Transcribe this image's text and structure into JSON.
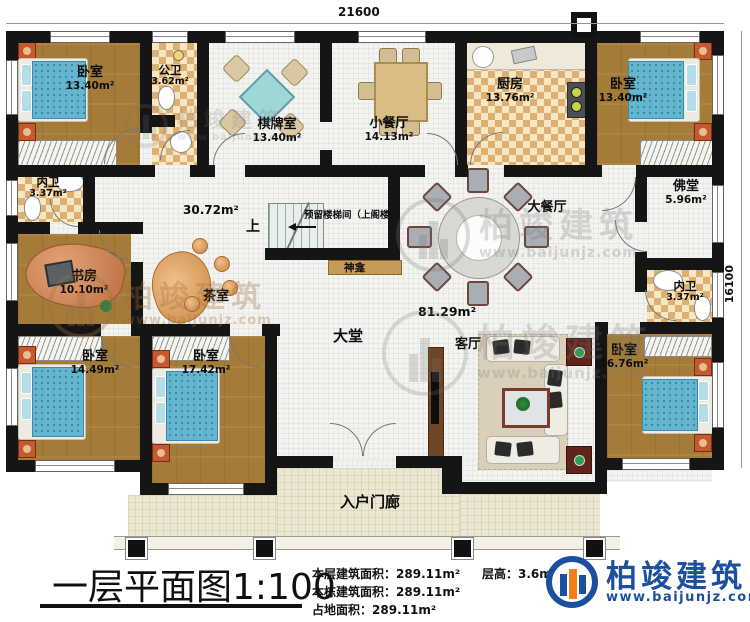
{
  "dimensions": {
    "top": "21600",
    "right": "16100"
  },
  "rooms": {
    "bedroom_tl": {
      "label": "卧室",
      "area": "13.40m²"
    },
    "public_bath": {
      "label": "公卫",
      "area": "3.62m²"
    },
    "chess_room": {
      "label": "棋牌室",
      "area": "13.40m²"
    },
    "small_dining": {
      "label": "小餐厅",
      "area": "14.13m²"
    },
    "kitchen": {
      "label": "厨房",
      "area": "13.76m²"
    },
    "bedroom_tr": {
      "label": "卧室",
      "area": "13.40m²"
    },
    "inner_bath_left": {
      "label": "内卫",
      "area": "3.37m²"
    },
    "study": {
      "label": "书房",
      "area": "10.10m²"
    },
    "tea_room": {
      "label": "茶室"
    },
    "main_dining": {
      "label": "大餐厅"
    },
    "buddha_hall": {
      "label": "佛堂",
      "area": "5.96m²"
    },
    "inner_bath_right": {
      "label": "内卫",
      "area": "3.37m²"
    },
    "bedroom_bl": {
      "label": "卧室",
      "area": "14.49m²"
    },
    "bedroom_bm": {
      "label": "卧室",
      "area": "17.42m²"
    },
    "great_hall": {
      "label": "大堂"
    },
    "living_room": {
      "label": "客厅"
    },
    "bedroom_br": {
      "label": "卧室",
      "area": "16.76m²"
    },
    "porch": {
      "label": "入户门廊"
    }
  },
  "annotations": {
    "tea_area": "30.72m²",
    "hall_area": "81.29m²",
    "stair_up": "上",
    "stair_note": "预留楼梯间（上阁楼）",
    "shrine": "神龛"
  },
  "title": {
    "text": "一层平面图",
    "scale": "1:100"
  },
  "stats": {
    "line1_label": "本层建筑面积：",
    "line1_value": "289.11m²",
    "line2_label": "本栋建筑面积：",
    "line2_value": "289.11m²",
    "line3_label": "占地面积：",
    "line3_value": "289.11m²",
    "height_label": "层高：",
    "height_value": "3.6m"
  },
  "brand": {
    "name": "柏竣建筑",
    "url": "www.baijunjz.com"
  },
  "watermark": {
    "name": "柏竣建筑",
    "url": "www.baijunjz.com"
  },
  "colors": {
    "brand_blue": "#1c4f9e",
    "brand_orange": "#f08017",
    "wall": "#151515"
  }
}
